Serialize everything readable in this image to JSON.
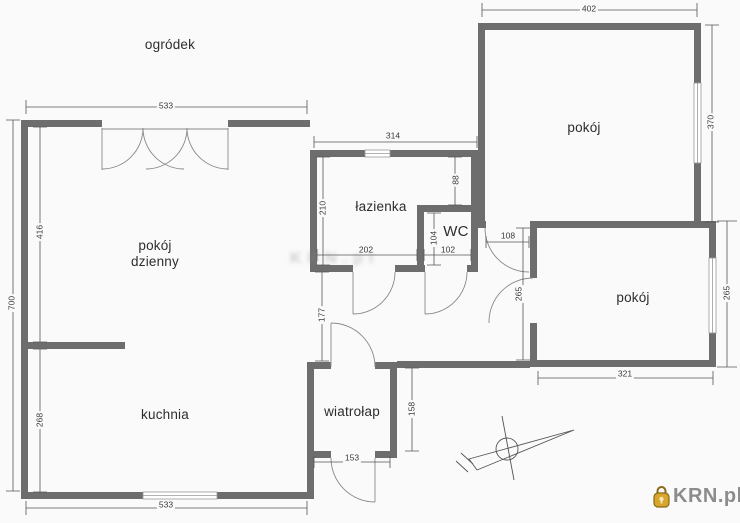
{
  "plan": {
    "rooms": {
      "garden": {
        "label": "ogródek"
      },
      "living": {
        "line1": "pokój",
        "line2": "dzienny"
      },
      "kitchen": {
        "label": "kuchnia"
      },
      "bathroom": {
        "label": "łazienka"
      },
      "wc": {
        "label": "WC"
      },
      "vestibule": {
        "label": "wiatrołap"
      },
      "room_top": {
        "label": "pokój"
      },
      "room_bottom": {
        "label": "pokój"
      }
    },
    "dimensions": {
      "living_top_width": "533",
      "room_top_width": "402",
      "room_top_height": "370",
      "bathroom_top_width": "314",
      "living_height": "416",
      "left_total_height": "700",
      "kitchen_height": "268",
      "bathroom_height": "210",
      "bathroom_right_gap": "88",
      "bathroom_width": "202",
      "wc_height": "104",
      "wc_width": "102",
      "room_top_door": "108",
      "hall_height": "265",
      "room_bottom_height": "265",
      "room_bottom_width": "321",
      "hall_opening": "177",
      "vestibule_height": "158",
      "vestibule_door": "153",
      "kitchen_bottom_width": "533"
    },
    "colors": {
      "wall": "#6d6d6d",
      "thin_line": "#8a8a8a",
      "dim_line": "#555555"
    }
  },
  "watermark": {
    "text": "KRN.pl"
  },
  "branding": {
    "logo_text": "KRN.pl",
    "text_color": "#8c8c8c",
    "lock_gold": "#d8a62a"
  }
}
